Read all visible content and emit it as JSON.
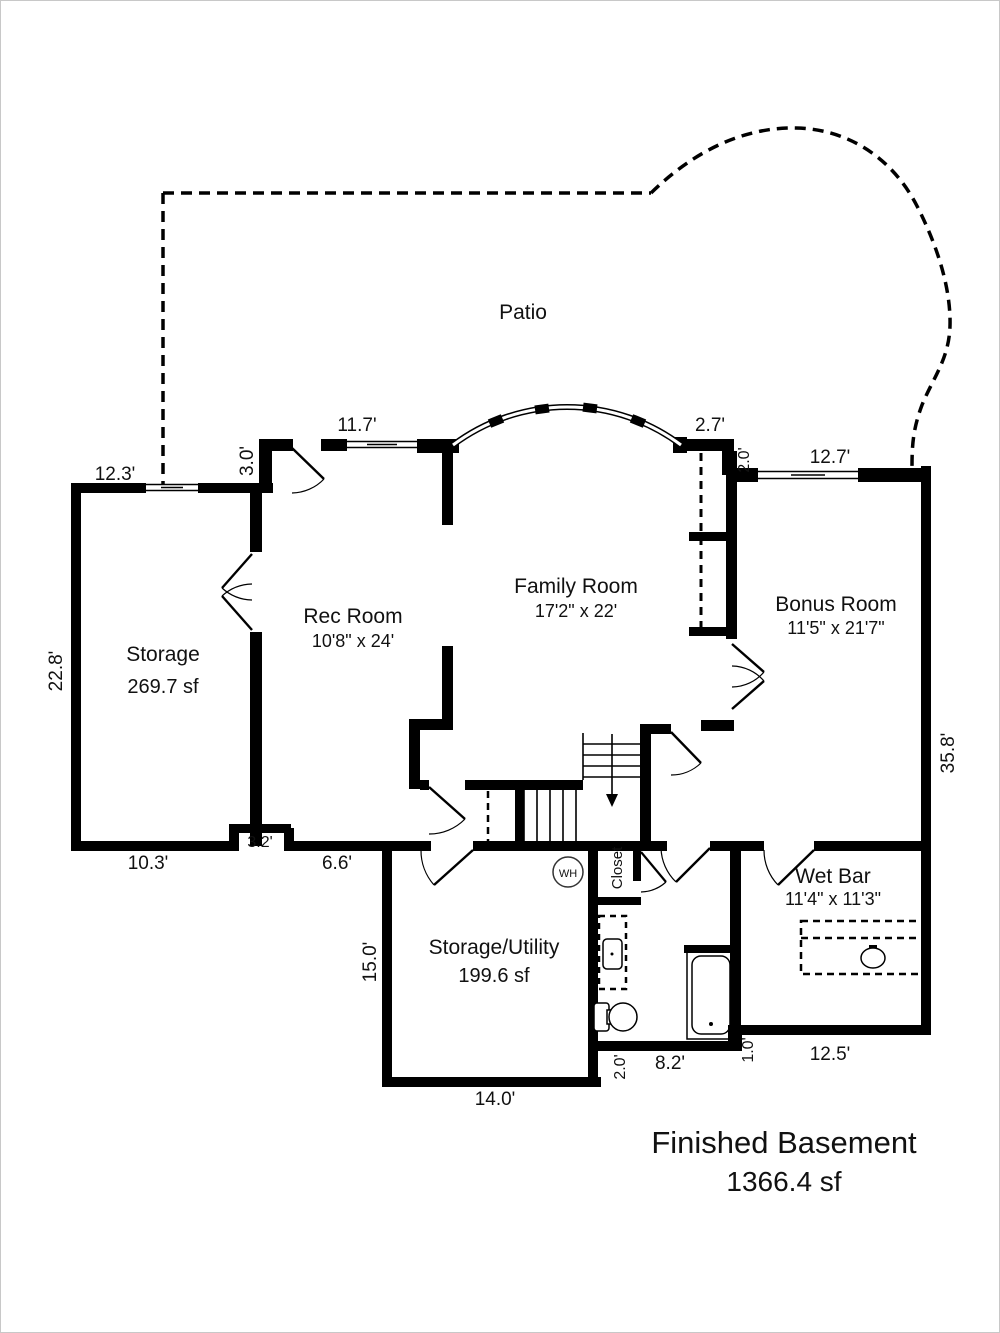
{
  "plan": {
    "patio_label": "Patio",
    "title_line1": "Finished Basement",
    "title_line2": "1366.4 sf"
  },
  "rooms": {
    "storage": {
      "name": "Storage",
      "size": "269.7 sf"
    },
    "rec_room": {
      "name": "Rec Room",
      "size": "10'8\" x 24'"
    },
    "family_room": {
      "name": "Family Room",
      "size": "17'2\" x 22'"
    },
    "bonus_room": {
      "name": "Bonus Room",
      "size": "11'5\" x 21'7\""
    },
    "wet_bar": {
      "name": "Wet Bar",
      "size": "11'4\" x 11'3\""
    },
    "storage_utility": {
      "name": "Storage/Utility",
      "size": "199.6 sf"
    },
    "closet": {
      "name": "Closet"
    },
    "water_heater": {
      "abbr": "WH"
    }
  },
  "dimensions": {
    "storage_top": "12.3'",
    "rec_step": "3.0'",
    "rec_window": "11.7'",
    "family_step": "2.7'",
    "bonus_step": "2.0'",
    "bonus_window": "12.7'",
    "storage_left": "22.8'",
    "right_side": "35.8'",
    "storage_bottom": "10.3'",
    "notch": "3.2'",
    "hall_bottom": "6.6'",
    "utility_left": "15.0'",
    "utility_bottom": "14.0'",
    "bath_step": "2.0'",
    "bath_bottom": "8.2'",
    "tub_step": "1.0'",
    "wetbar_bottom": "12.5'"
  },
  "colors": {
    "wall": "#000000",
    "text": "#111111",
    "background": "#ffffff"
  }
}
